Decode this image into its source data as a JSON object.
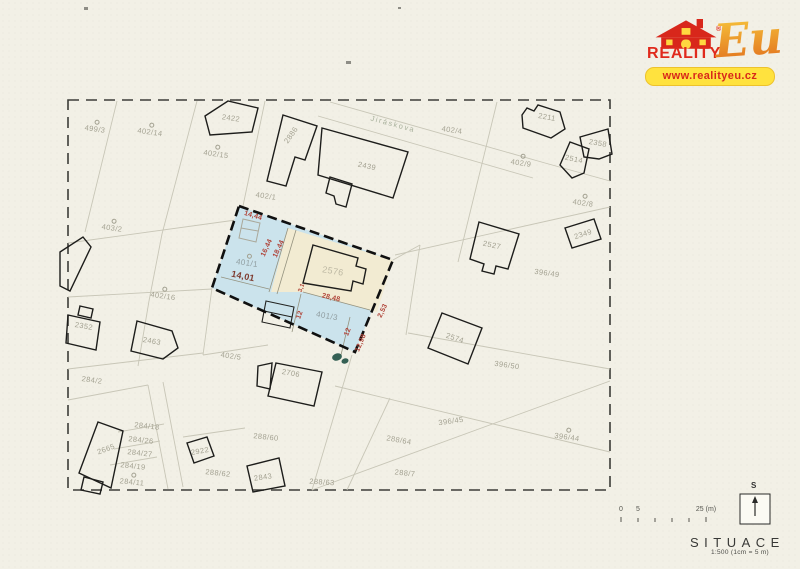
{
  "logo": {
    "brand": "REALITY",
    "suffix": "Eu",
    "registered": "®",
    "url": "www.realityeu.cz"
  },
  "titleblock": {
    "title": "SITUACE",
    "scale_note": "1:500 (1cm = 5 m)",
    "north_label": "S",
    "scalebar_labels": [
      {
        "text": "0",
        "x": 621
      },
      {
        "text": "5",
        "x": 638
      },
      {
        "text": "25 (m)",
        "x": 706
      }
    ]
  },
  "colors": {
    "paper": "#f2f0e6",
    "plot_blue": "#cbe3ec",
    "plot_beige": "#f2ebd2",
    "dimension_red": "#b0453a",
    "logo_red": "#e02a1c",
    "logo_yellow": "#ffe23e"
  },
  "map": {
    "labels": [
      {
        "text": "499/3",
        "x": 95,
        "y": 129,
        "rot": 8,
        "cls": "parcel",
        "marker": true
      },
      {
        "text": "402/14",
        "x": 150,
        "y": 132,
        "rot": 8,
        "cls": "parcel",
        "marker": true
      },
      {
        "text": "402/15",
        "x": 216,
        "y": 154,
        "rot": 8,
        "cls": "parcel",
        "marker": true
      },
      {
        "text": "2422",
        "x": 231,
        "y": 118,
        "rot": 8,
        "cls": "parcel"
      },
      {
        "text": "2886",
        "x": 291,
        "y": 135,
        "rot": -55,
        "cls": "parcel"
      },
      {
        "text": "2439",
        "x": 367,
        "y": 166,
        "rot": 12,
        "cls": "parcel"
      },
      {
        "text": "Jiráskova",
        "x": 393,
        "y": 124,
        "rot": 15,
        "cls": "street"
      },
      {
        "text": "402/1",
        "x": 266,
        "y": 196,
        "rot": 8,
        "cls": "parcel"
      },
      {
        "text": "402/4",
        "x": 452,
        "y": 130,
        "rot": 8,
        "cls": "parcel"
      },
      {
        "text": "2211",
        "x": 547,
        "y": 117,
        "rot": 10,
        "cls": "parcel"
      },
      {
        "text": "2358",
        "x": 598,
        "y": 143,
        "rot": 10,
        "cls": "parcel"
      },
      {
        "text": "2514",
        "x": 574,
        "y": 159,
        "rot": 12,
        "cls": "parcel"
      },
      {
        "text": "402/9",
        "x": 521,
        "y": 163,
        "rot": 8,
        "cls": "parcel",
        "marker": true
      },
      {
        "text": "402/8",
        "x": 583,
        "y": 203,
        "rot": 8,
        "cls": "parcel",
        "marker": true
      },
      {
        "text": "2527",
        "x": 492,
        "y": 245,
        "rot": 12,
        "cls": "parcel"
      },
      {
        "text": "2349",
        "x": 583,
        "y": 234,
        "rot": -18,
        "cls": "parcel"
      },
      {
        "text": "396/49",
        "x": 547,
        "y": 273,
        "rot": 8,
        "cls": "parcel"
      },
      {
        "text": "2574",
        "x": 455,
        "y": 338,
        "rot": 18,
        "cls": "parcel"
      },
      {
        "text": "396/50",
        "x": 507,
        "y": 365,
        "rot": 8,
        "cls": "parcel"
      },
      {
        "text": "403/2",
        "x": 112,
        "y": 228,
        "rot": 8,
        "cls": "parcel",
        "marker": true
      },
      {
        "text": "402/16",
        "x": 163,
        "y": 296,
        "rot": 8,
        "cls": "parcel",
        "marker": true
      },
      {
        "text": "2352",
        "x": 84,
        "y": 326,
        "rot": 10,
        "cls": "parcel"
      },
      {
        "text": "2463",
        "x": 152,
        "y": 341,
        "rot": 10,
        "cls": "parcel"
      },
      {
        "text": "402/5",
        "x": 231,
        "y": 356,
        "rot": 8,
        "cls": "parcel"
      },
      {
        "text": "284/2",
        "x": 92,
        "y": 380,
        "rot": 8,
        "cls": "parcel"
      },
      {
        "text": "2665",
        "x": 106,
        "y": 449,
        "rot": -20,
        "cls": "parcel"
      },
      {
        "text": "284/18",
        "x": 147,
        "y": 426,
        "rot": 6,
        "cls": "parcel"
      },
      {
        "text": "284/26",
        "x": 141,
        "y": 440,
        "rot": 6,
        "cls": "parcel"
      },
      {
        "text": "284/27",
        "x": 140,
        "y": 453,
        "rot": 6,
        "cls": "parcel"
      },
      {
        "text": "284/19",
        "x": 133,
        "y": 466,
        "rot": 6,
        "cls": "parcel"
      },
      {
        "text": "284/11",
        "x": 132,
        "y": 482,
        "rot": 6,
        "cls": "parcel",
        "marker": true
      },
      {
        "text": "2922",
        "x": 200,
        "y": 451,
        "rot": -10,
        "cls": "parcel"
      },
      {
        "text": "288/62",
        "x": 218,
        "y": 473,
        "rot": 6,
        "cls": "parcel"
      },
      {
        "text": "288/60",
        "x": 266,
        "y": 437,
        "rot": 6,
        "cls": "parcel"
      },
      {
        "text": "2706",
        "x": 291,
        "y": 373,
        "rot": 10,
        "cls": "parcel"
      },
      {
        "text": "2843",
        "x": 263,
        "y": 477,
        "rot": -8,
        "cls": "parcel"
      },
      {
        "text": "288/63",
        "x": 322,
        "y": 482,
        "rot": 4,
        "cls": "parcel"
      },
      {
        "text": "288/7",
        "x": 405,
        "y": 473,
        "rot": 6,
        "cls": "parcel"
      },
      {
        "text": "288/64",
        "x": 399,
        "y": 440,
        "rot": 10,
        "cls": "parcel"
      },
      {
        "text": "396/45",
        "x": 451,
        "y": 421,
        "rot": -8,
        "cls": "parcel"
      },
      {
        "text": "396/44",
        "x": 567,
        "y": 437,
        "rot": 8,
        "cls": "parcel",
        "marker": true
      },
      {
        "text": "2576",
        "x": 333,
        "y": 271,
        "rot": 10,
        "cls": "parcel",
        "fs": 9,
        "col": "#bdb8a3"
      },
      {
        "text": "401/1",
        "x": 247,
        "y": 263,
        "rot": 8,
        "cls": "parcel",
        "marker": true,
        "fs": 8,
        "col": "#909da0"
      },
      {
        "text": "401/3",
        "x": 327,
        "y": 316,
        "rot": 10,
        "cls": "parcel",
        "fs": 8,
        "col": "#909da0"
      },
      {
        "text": "14,44",
        "x": 253,
        "y": 216,
        "rot": 17,
        "cls": "dim"
      },
      {
        "text": "16,44",
        "x": 267,
        "y": 248,
        "rot": -65,
        "cls": "dim"
      },
      {
        "text": "18,44",
        "x": 279,
        "y": 249,
        "rot": -65,
        "cls": "dim"
      },
      {
        "text": "14,01",
        "x": 243,
        "y": 276,
        "rot": 12,
        "cls": "dim",
        "fs": 9,
        "col": "#7e3a2e"
      },
      {
        "text": "28,48",
        "x": 331,
        "y": 298,
        "rot": 13,
        "cls": "dim"
      },
      {
        "text": "12",
        "x": 300,
        "y": 315,
        "rot": -70,
        "cls": "dim"
      },
      {
        "text": "12",
        "x": 348,
        "y": 332,
        "rot": -68,
        "cls": "dim"
      },
      {
        "text": "12,98",
        "x": 361,
        "y": 343,
        "rot": -68,
        "cls": "dim"
      },
      {
        "text": "2,53",
        "x": 383,
        "y": 311,
        "rot": -65,
        "cls": "dim"
      },
      {
        "text": "3,1",
        "x": 302,
        "y": 288,
        "rot": -70,
        "cls": "dim",
        "fs": 6
      }
    ]
  }
}
